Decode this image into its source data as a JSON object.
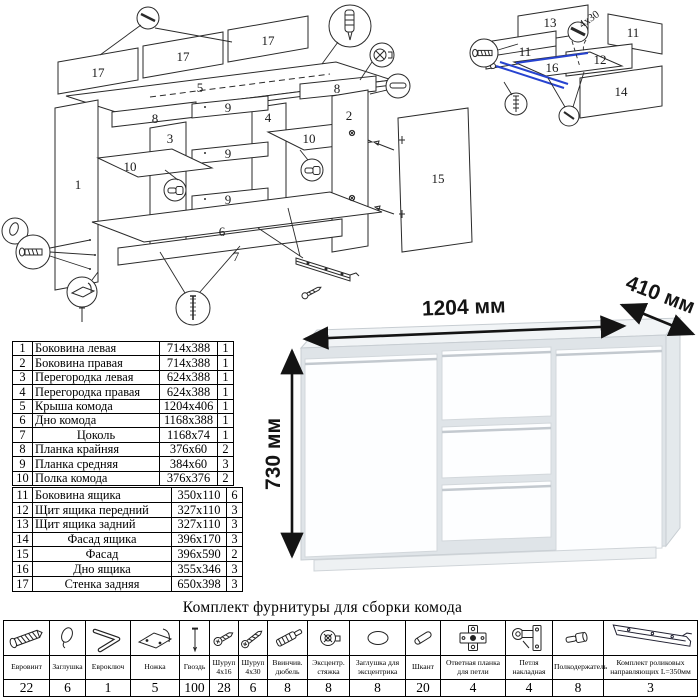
{
  "title": "Комплект фурнитуры для сборки комода",
  "dimensions": {
    "width": "1204 мм",
    "depth": "410 мм",
    "height": "730 мм"
  },
  "parts": [
    {
      "num": "1",
      "name": "Боковина левая",
      "size": "714x388",
      "qty": "1"
    },
    {
      "num": "2",
      "name": "Боковина правая",
      "size": "714x388",
      "qty": "1"
    },
    {
      "num": "3",
      "name": "Перегородка левая",
      "size": "624x388",
      "qty": "1"
    },
    {
      "num": "4",
      "name": "Перегородка правая",
      "size": "624x388",
      "qty": "1"
    },
    {
      "num": "5",
      "name": "Крыша комода",
      "size": "1204x406",
      "qty": "1"
    },
    {
      "num": "6",
      "name": "Дно комода",
      "size": "1168x388",
      "qty": "1"
    },
    {
      "num": "7",
      "name": "Цоколь",
      "size": "1168x74",
      "qty": "1"
    },
    {
      "num": "8",
      "name": "Планка крайняя",
      "size": "376x60",
      "qty": "2"
    },
    {
      "num": "9",
      "name": "Планка средняя",
      "size": "384x60",
      "qty": "3"
    },
    {
      "num": "10",
      "name": "Полка комода",
      "size": "376x376",
      "qty": "2"
    },
    {
      "num": "11",
      "name": "Боковина ящика",
      "size": "350x110",
      "qty": "6"
    },
    {
      "num": "12",
      "name": "Щит ящика передний",
      "size": "327x110",
      "qty": "3"
    },
    {
      "num": "13",
      "name": "Щит ящика задний",
      "size": "327x110",
      "qty": "3"
    },
    {
      "num": "14",
      "name": "Фасад ящика",
      "size": "396x170",
      "qty": "3"
    },
    {
      "num": "15",
      "name": "Фасад",
      "size": "396x590",
      "qty": "2"
    },
    {
      "num": "16",
      "name": "Дно ящика",
      "size": "355x346",
      "qty": "3"
    },
    {
      "num": "17",
      "name": "Стенка задняя",
      "size": "650x398",
      "qty": "3"
    }
  ],
  "hardware": [
    {
      "name": "Евровинт",
      "qty": "22"
    },
    {
      "name": "Заглушка",
      "qty": "6"
    },
    {
      "name": "Евроключ",
      "qty": "1"
    },
    {
      "name": "Ножка",
      "qty": "5"
    },
    {
      "name": "Гвоздь",
      "qty": "100"
    },
    {
      "name": "Шуруп 4x16",
      "qty": "28"
    },
    {
      "name": "Шуруп 4x30",
      "qty": "6"
    },
    {
      "name": "Ввинчив. дюбель",
      "qty": "8"
    },
    {
      "name": "Эксцентр. стяжка",
      "qty": "8"
    },
    {
      "name": "Заглушка для эксцентрика",
      "qty": "8"
    },
    {
      "name": "Шкант",
      "qty": "20"
    },
    {
      "name": "Ответная планка для петли",
      "qty": "4"
    },
    {
      "name": "Петля накладная",
      "qty": "4"
    },
    {
      "name": "Полкодержатель",
      "qty": "8"
    },
    {
      "name": "Комплект роликовых направляющих L=350мм",
      "qty": "3"
    }
  ],
  "main_diagram": {
    "labels": [
      "17",
      "17",
      "17",
      "5",
      "8",
      "8",
      "9",
      "9",
      "9",
      "3",
      "4",
      "1",
      "2",
      "10",
      "10",
      "6",
      "7",
      "15"
    ]
  },
  "drawer_diagram": {
    "labels": [
      "13",
      "11",
      "11",
      "12",
      "16",
      "14"
    ],
    "screw_label": "4x30"
  },
  "colors": {
    "accent_blue": "#2743d0",
    "line": "#2a2a2a"
  }
}
